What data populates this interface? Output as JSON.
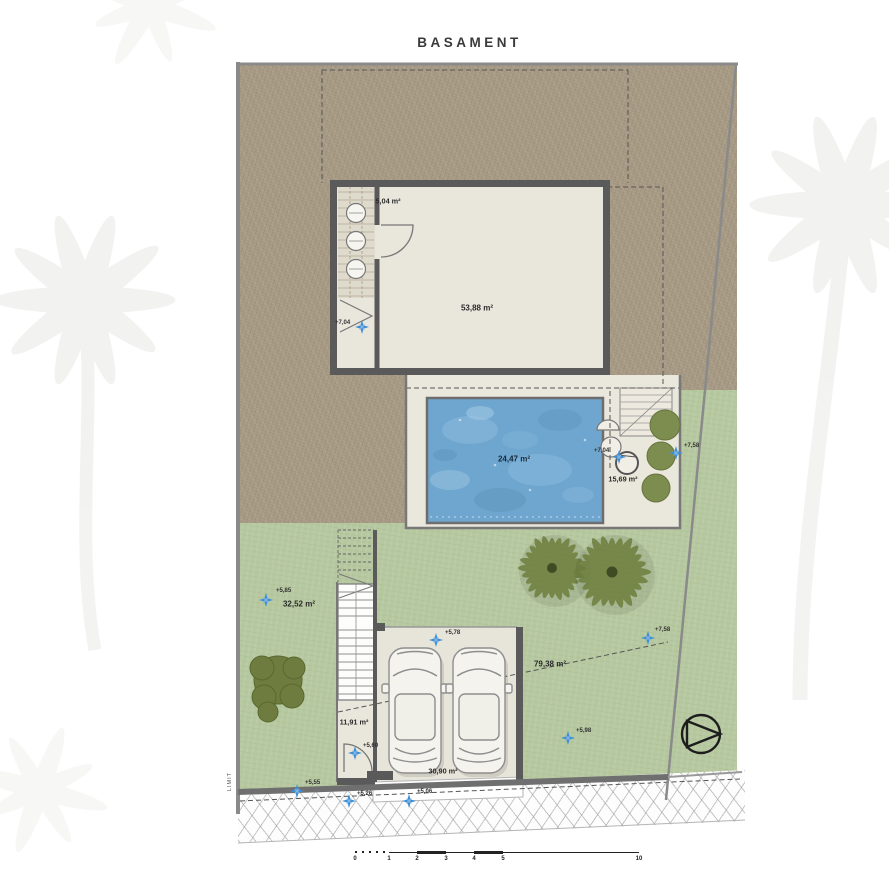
{
  "title": "BASAMENT",
  "areas": {
    "services": "5,04 m²",
    "basement": "53,88 m²",
    "pool": "24,47 m²",
    "deck": "15,69 m²",
    "lawn_left": "32,52 m²",
    "lawn_right": "79,38 m²",
    "entry": "11,91 m²",
    "garage": "30,90 m²"
  },
  "levels": [
    "+7,04",
    "+7,04",
    "+7,58",
    "+5,85",
    "+5,78",
    "+5,60",
    "+5,98",
    "+5,55",
    "+5,26",
    "+5,06",
    "+7,58"
  ],
  "scale": {
    "labels": [
      "0",
      "1",
      "2",
      "3",
      "4",
      "5",
      "10"
    ]
  },
  "boundary": {
    "limit_label": "LIMIT"
  },
  "colors": {
    "terrain": "#a69983",
    "lawn": "#b6c8a0",
    "water": "#6ea6cf",
    "wall": "#5a5a5a",
    "marker": "#3f8fd4",
    "paper": "#ffffff"
  }
}
